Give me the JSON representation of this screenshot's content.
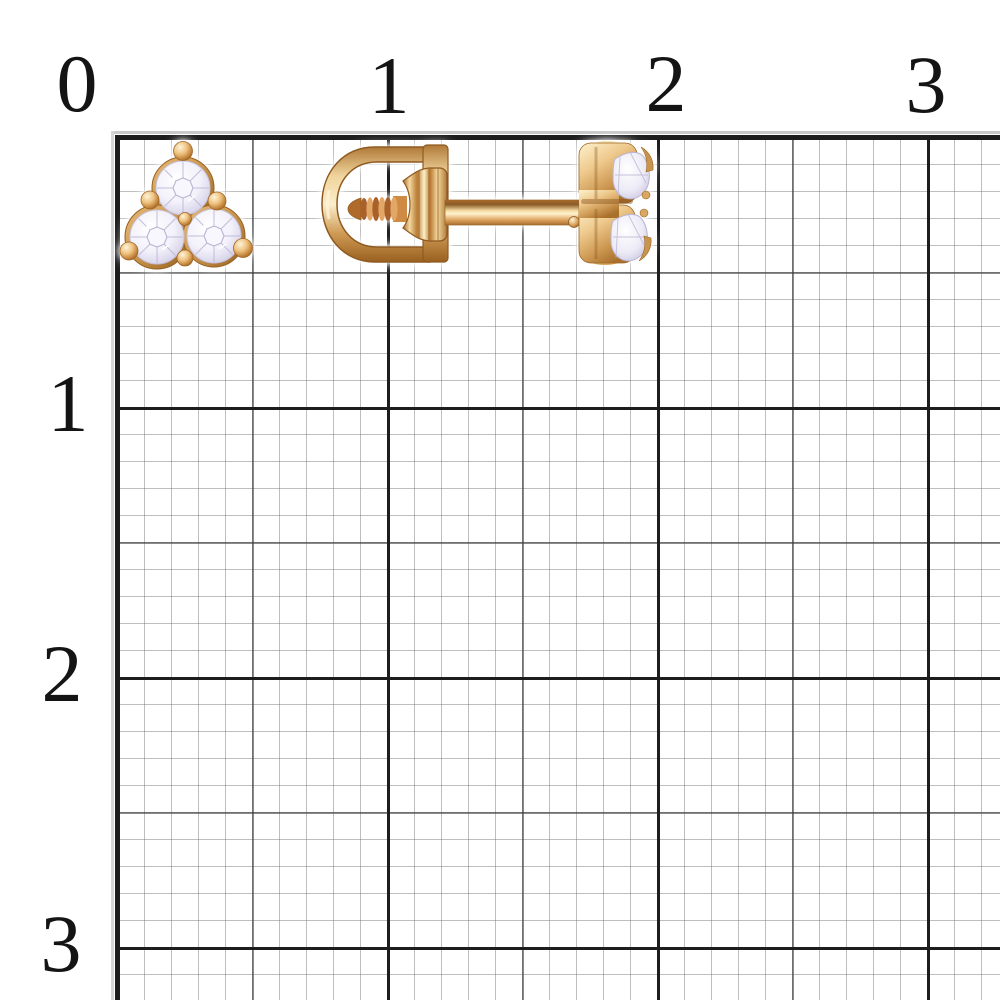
{
  "scene": {
    "kind": "jewelry-product-photo-on-graph-paper",
    "subject": "pair of gold screw-back stud earrings with three-stone clusters on millimeter grid"
  },
  "ruler": {
    "unit": "cm",
    "top_labels": [
      {
        "text": "0"
      },
      {
        "text": "1"
      },
      {
        "text": "2"
      },
      {
        "text": "3"
      }
    ],
    "left_labels": [
      {
        "text": "1"
      },
      {
        "text": "2"
      },
      {
        "text": "3"
      }
    ]
  },
  "grid": {
    "minor_cell_px": 27,
    "medium_cell_px": 135,
    "major_cell_px": 270,
    "origin_x_px": 117,
    "origin_y_px": 137
  },
  "items": [
    {
      "name": "stud-earring-front-view",
      "stones": 3,
      "stone_cut": "round"
    },
    {
      "name": "stud-earring-side-view",
      "parts": [
        "screw-back-clasp",
        "threaded-post",
        "stone-cluster-head"
      ]
    }
  ],
  "palette": {
    "bg": "#ffffff",
    "label_color": "#141414",
    "grid_major": "#1d1d1d",
    "grid_medium": "rgba(60,60,60,0.6)",
    "grid_minor": "rgba(110,110,110,0.45)",
    "gold_highlight": "#fdf4d9",
    "gold_light": "#f2d9a2",
    "gold_mid": "#dca25c",
    "gold_dark": "#b97c35",
    "gold_shadow": "#8f5a22",
    "stone_base": "#f1eff8",
    "stone_facet": "#b9b4d2"
  }
}
